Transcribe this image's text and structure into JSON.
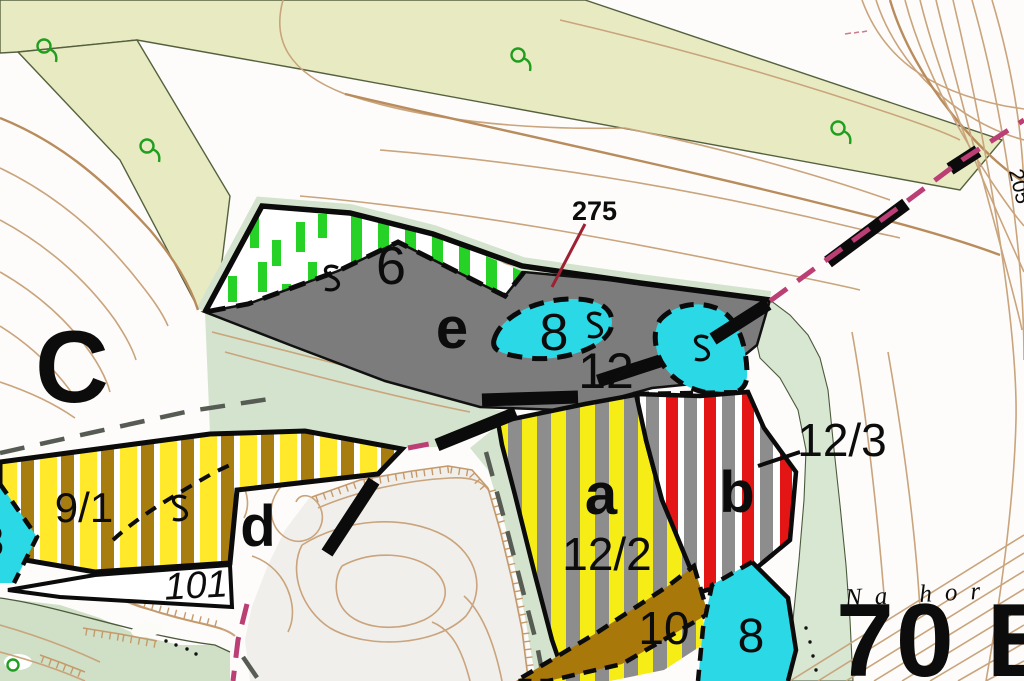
{
  "map": {
    "stand_labels": {
      "top_left": "0 C",
      "bottom_right": "70 B"
    },
    "place_name": "Na hor",
    "contour_elevation_label": "205",
    "height_point_label": "275",
    "compartment_labels": {
      "c6": "6",
      "c12": "12",
      "c9_1": "9/1",
      "c101": "101",
      "c12_2": "12/2",
      "c12_3": "12/3",
      "c10": "10"
    },
    "cyan_area_labels": {
      "lens": "8",
      "bottom": "8",
      "left_edge": "8"
    },
    "substand_letters": {
      "a": "a",
      "b": "b",
      "d": "d",
      "e": "e"
    },
    "colors": {
      "khaki_stand": "#e8ebc2",
      "sage_stand": "#d4e3cd",
      "gray_stand": "#7c7c7c",
      "cyan_area": "#2ad8e6",
      "green_bars": "#27d227",
      "yellow_stripe": "#f6ec16",
      "brown_stripe": "#a87d10",
      "red_stripe": "#e41515",
      "contour": "#c9a47c",
      "magenta_boundary": "#bb3f74",
      "height_point_red": "#9e2033"
    }
  }
}
